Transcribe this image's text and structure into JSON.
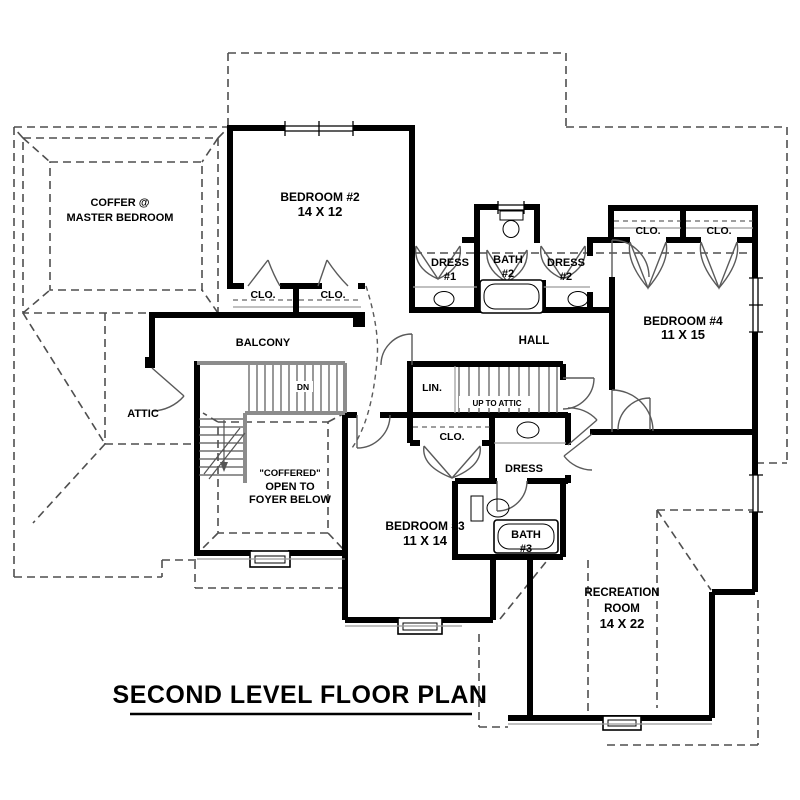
{
  "title": {
    "text": "SECOND LEVEL FLOOR PLAN"
  },
  "rooms": {
    "master_coffer": {
      "line1": "COFFER @",
      "line2": "MASTER BEDROOM"
    },
    "bedroom2": {
      "name": "BEDROOM #2",
      "dims": "14 X 12"
    },
    "bedroom3": {
      "name": "BEDROOM #3",
      "dims": "11 X 14"
    },
    "bedroom4": {
      "name": "BEDROOM #4",
      "dims": "11 X 15"
    },
    "recreation": {
      "name_line1": "RECREATION",
      "name_line2": "ROOM",
      "dims": "14 X 22"
    },
    "balcony": {
      "name": "BALCONY"
    },
    "hall": {
      "name": "HALL"
    },
    "attic": {
      "name": "ATTIC"
    },
    "linen": {
      "name": "LIN."
    },
    "bath2": {
      "name_line1": "BATH",
      "name_line2": "#2"
    },
    "bath3": {
      "name_line1": "BATH",
      "name_line2": "#3"
    },
    "dress1": {
      "name_line1": "DRESS",
      "name_line2": "#1"
    },
    "dress2": {
      "name_line1": "DRESS",
      "name_line2": "#2"
    },
    "dress_hall": {
      "name": "DRESS"
    },
    "foyer_open": {
      "line1": "\"COFFERED\"",
      "line2": "OPEN TO",
      "line3": "FOYER BELOW"
    }
  },
  "closets": {
    "bedroom2_left": "CLO.",
    "bedroom2_right": "CLO.",
    "bedroom4_left": "CLO.",
    "bedroom4_right": "CLO.",
    "hall_center": "CLO."
  },
  "stairs": {
    "down_label": "DN",
    "up_label": "UP TO ATTIC"
  },
  "colors": {
    "wall": "#000000",
    "dashed_roof": "#4f4f4f",
    "stair_gray": "#8c8c8c",
    "text": "#000000",
    "background": "#ffffff"
  }
}
